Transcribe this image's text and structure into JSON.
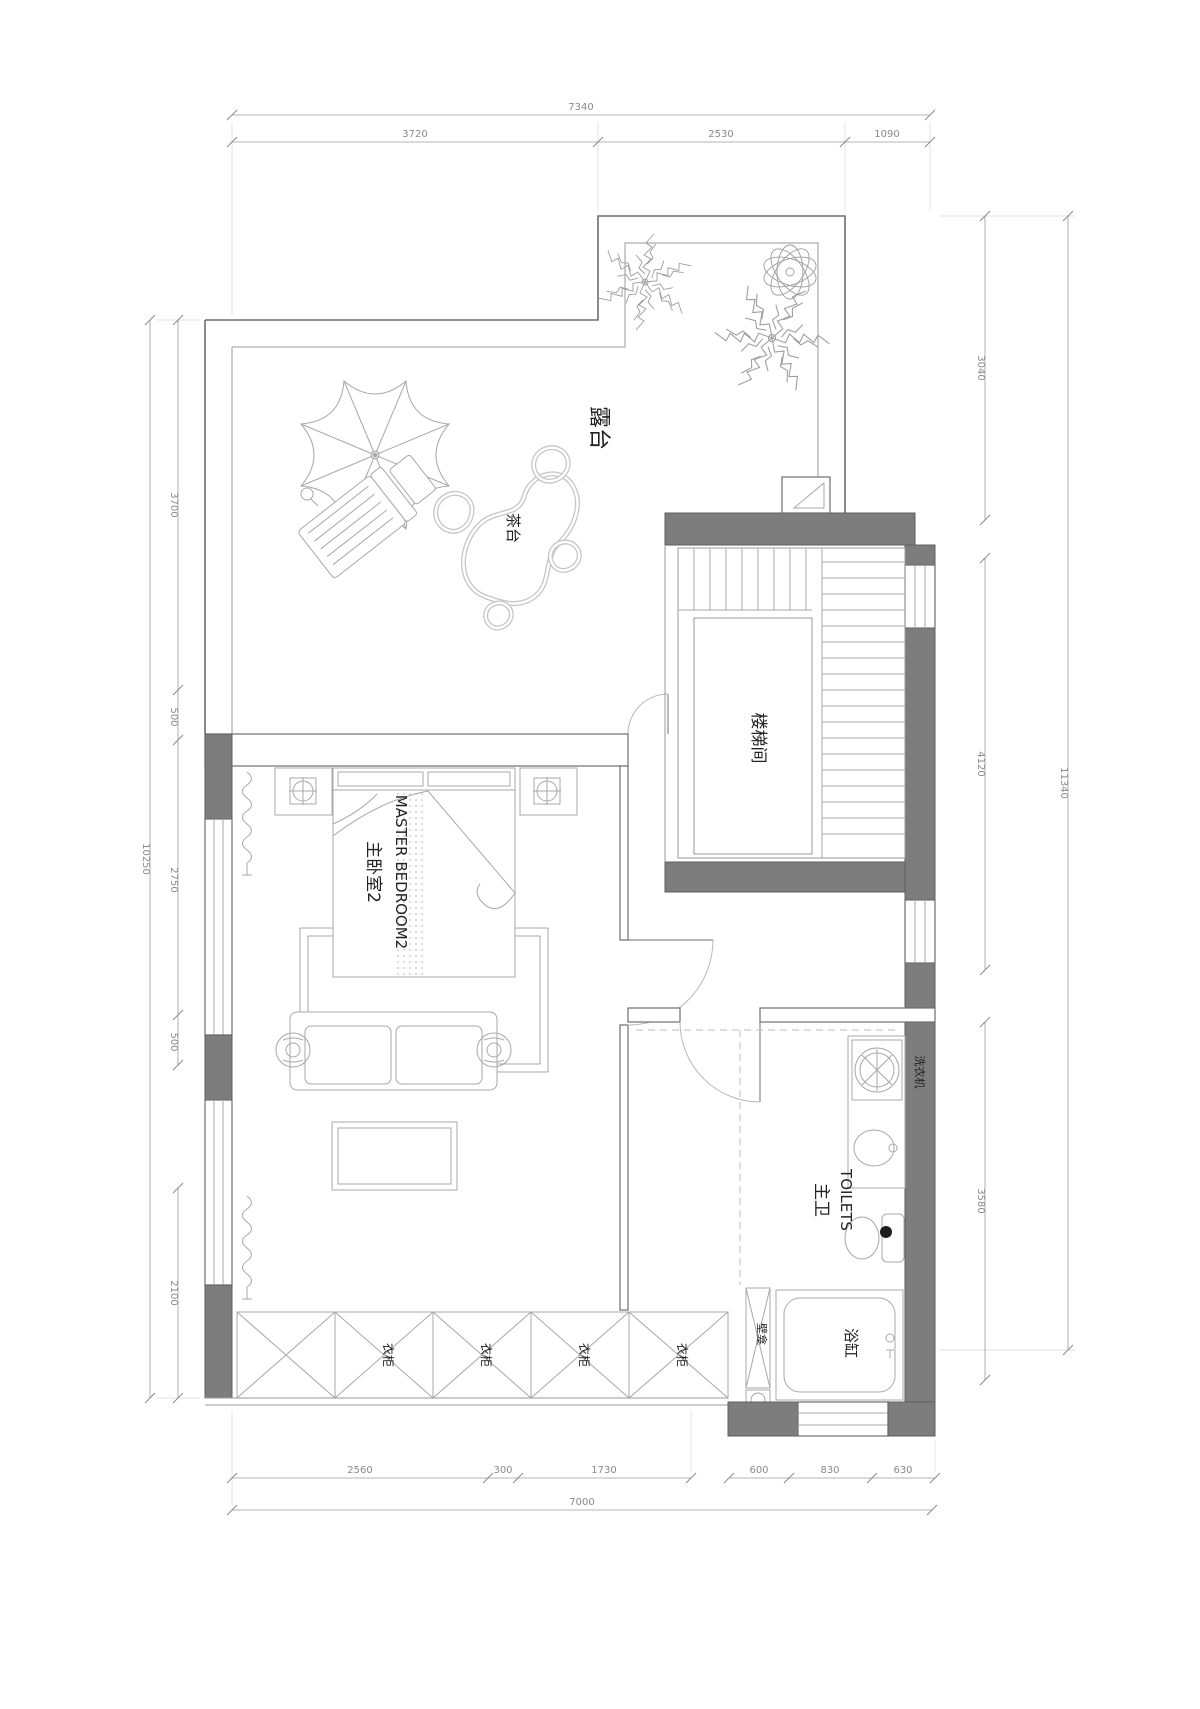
{
  "plan": {
    "rooms": {
      "terrace": "露台",
      "tea_table": "茶台",
      "stairwell": "楼梯间",
      "master_bedroom_cn": "主卧室2",
      "master_bedroom_en": "MASTER BEDROOM2",
      "bathroom_cn": "主卫",
      "bathroom_en": "TOILETS"
    },
    "fixtures": {
      "washing_machine": "洗衣机",
      "niche": "壁龛",
      "bathtub": "浴缸",
      "wardrobes": [
        "衣柜",
        "衣柜",
        "衣柜",
        "衣柜"
      ]
    },
    "dimensions": {
      "top": {
        "overall": "7340",
        "segments": [
          "3720",
          "2530",
          "1090"
        ]
      },
      "bottom": {
        "overall": "7000",
        "segments_left": [
          "2560",
          "300",
          "1730"
        ],
        "segments_right": [
          "600",
          "830",
          "630"
        ]
      },
      "left": {
        "overall": "10250",
        "segments": [
          "3700",
          "500",
          "2750",
          "500",
          "2100"
        ]
      },
      "right": {
        "overall": "11340",
        "segments": [
          "3040",
          "4120",
          "3580"
        ]
      }
    },
    "colors": {
      "wall": "#7d7d7d",
      "line": "#6e6e6e",
      "thin": "#a8a8a8",
      "label": "#222222",
      "dim": "#8a8a8a"
    }
  }
}
